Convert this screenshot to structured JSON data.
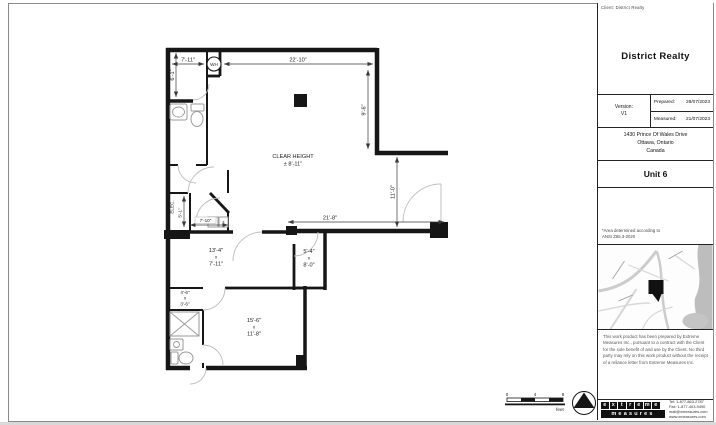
{
  "titleblock": {
    "client_label": "Client: District Realty",
    "company": "District Realty",
    "version_label": "Version:",
    "version_value": "V1",
    "prepared_label": "Prepared:",
    "prepared_date": "28/07/2023",
    "measured_label": "Measured:",
    "measured_date": "21/07/2023",
    "address_line1": "1430 Prince Of Wales Drive",
    "address_line2": "Ottawa, Ontario",
    "address_line3": "Canada",
    "unit": "Unit 6",
    "area_note_line1": "*Area determined according to",
    "area_note_line2": "ANSI Z65.3-2020",
    "disclaimer": "This work product has been prepared by Extreme Measures Inc., pursuant to a contract with the Client for the sole benefit of and use by the Client. No third party may rely on this work product without the receipt of a reliance letter from Extreme Measures Inc.",
    "logo_line1": "extreme",
    "logo_line2": "measures",
    "contact_tel": "Tel: 1-877-863-2787",
    "contact_fax": "Fax: 1-877-403-9490",
    "contact_email": "mail@xmeasures.com",
    "contact_web": "www.xmeasures.com"
  },
  "plan": {
    "labels": {
      "water_heater": "WH",
      "clear_height_1": "CLEAR HEIGHT",
      "clear_height_2": "± 8'-11\"",
      "elec": "ELEC."
    },
    "dimensions": {
      "entry_width": "7'-11\"",
      "main_width": "22'-10\"",
      "entry_depth": "6'-1\"",
      "right_upper": "9'-6\"",
      "right_lower": "11'-0\"",
      "bottom_main": "21'-8\"",
      "elec_depth": "5'-1\"",
      "vestibule_width": "7'-10\""
    },
    "rooms": [
      {
        "width": "13'-4\"",
        "sep": "x",
        "depth": "7'-11\""
      },
      {
        "width": "5'-4\"",
        "sep": "x",
        "depth": "8'-0\""
      },
      {
        "width": "4'-6\"",
        "sep": "x",
        "depth": "3'-6\""
      },
      {
        "width": "15'-6\"",
        "sep": "x",
        "depth": "11'-8\""
      }
    ],
    "scale_bar": {
      "tick0": "0",
      "tick1": "4",
      "tick2": "8",
      "unit": "feet"
    }
  }
}
